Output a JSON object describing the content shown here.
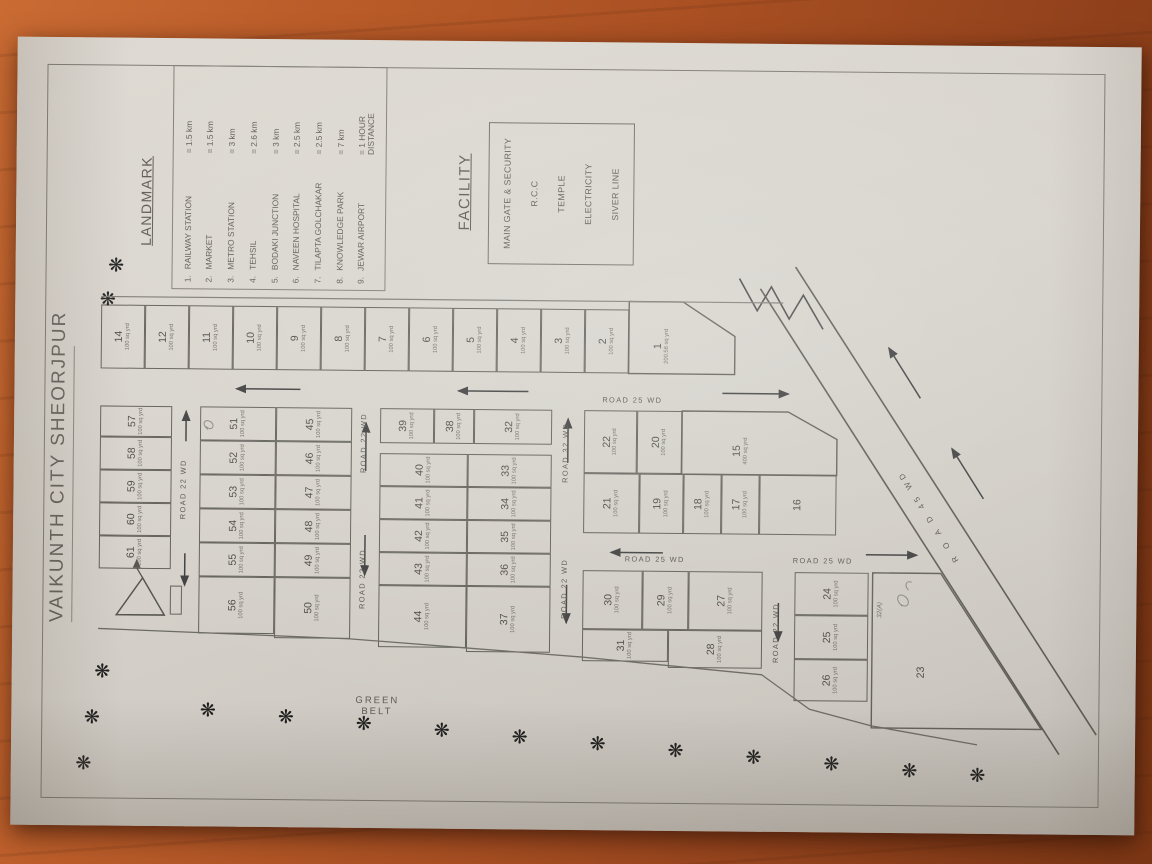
{
  "title": "VAIKUNTH CITY SHEORJPUR",
  "landmark": {
    "header": "LANDMARK",
    "items": [
      {
        "num": "1.",
        "name": "RAILWAY STATION",
        "value": "= 1.5 km"
      },
      {
        "num": "2.",
        "name": "MARKET",
        "value": "= 1.5 km"
      },
      {
        "num": "3.",
        "name": "METRO STATION",
        "value": "= 3 km"
      },
      {
        "num": "4.",
        "name": "TEHSIL",
        "value": "= 2.6 km"
      },
      {
        "num": "5.",
        "name": "BODAKI JUNCTION",
        "value": "= 3 km"
      },
      {
        "num": "6.",
        "name": "NAVEEN HOSPITAL",
        "value": "= 2.5 km"
      },
      {
        "num": "7.",
        "name": "TILAPTA GOLCHAKAR",
        "value": "= 2.5 km"
      },
      {
        "num": "8.",
        "name": "KNOWLEDGE PARK",
        "value": "= 7 km"
      },
      {
        "num": "9.",
        "name": "JEWAR AIRPORT",
        "value": "= 1 HOUR DISTANCE"
      }
    ]
  },
  "facility": {
    "header": "FACILITY",
    "items": [
      "MAIN GATE & SECURITY",
      "R.C.C",
      "TEMPLE",
      "ELECTRICITY",
      "SIVER LINE"
    ]
  },
  "green_belt": {
    "line1": "GREEN",
    "line2": "BELT"
  },
  "roads": {
    "r1": "ROAD 22 WD",
    "r2_left": "ROAD 22 WD",
    "r2_right": "ROAD 22 WD",
    "r3_left": "ROAD 22 WD",
    "r3_right": "ROAD 32 WD",
    "r4": "ROAD 22 WD",
    "v1": "ROAD 25 WD",
    "v2_upper": "ROAD 25 WD",
    "v2_lower": "ROAD 25 WD",
    "diag": "R O A D 45 WD"
  },
  "annotations": {
    "plot23_suffix": "32(A)"
  },
  "icons": {
    "tree": "❋"
  },
  "plots": {
    "1": {
      "n": "1",
      "a": "200.58 sq yrd"
    },
    "2": {
      "n": "2",
      "a": "100 sq yrd"
    },
    "3": {
      "n": "3",
      "a": "100 sq yrd"
    },
    "4": {
      "n": "4",
      "a": "100 sq yrd"
    },
    "5": {
      "n": "5",
      "a": "100 sq yrd"
    },
    "6": {
      "n": "6",
      "a": "100 sq yrd"
    },
    "7": {
      "n": "7",
      "a": "100 sq yrd"
    },
    "8": {
      "n": "8",
      "a": "100 sq yrd"
    },
    "9": {
      "n": "9",
      "a": "100 sq yrd"
    },
    "10": {
      "n": "10",
      "a": "100 sq yrd"
    },
    "11": {
      "n": "11",
      "a": "100 sq yrd"
    },
    "12": {
      "n": "12",
      "a": "100 sq yrd"
    },
    "14": {
      "n": "14",
      "a": "100 sq yrd"
    },
    "15": {
      "n": "15",
      "a": "400 sq yrd"
    },
    "16": {
      "n": "16"
    },
    "17": {
      "n": "17",
      "a": "100 sq yrd"
    },
    "18": {
      "n": "18",
      "a": "100 sq yrd"
    },
    "19": {
      "n": "19",
      "a": "100 sq yrd"
    },
    "20": {
      "n": "20",
      "a": "100 sq yrd"
    },
    "21": {
      "n": "21",
      "a": "100 sq yrd"
    },
    "22": {
      "n": "22",
      "a": "100 sq yrd"
    },
    "23": {
      "n": "23"
    },
    "24": {
      "n": "24",
      "a": "100 sq yrd"
    },
    "25": {
      "n": "25",
      "a": "100 sq yrd"
    },
    "26": {
      "n": "26",
      "a": "100 sq yrd"
    },
    "27": {
      "n": "27",
      "a": "100 sq yrd"
    },
    "28": {
      "n": "28",
      "a": "100 sq yrd"
    },
    "29": {
      "n": "29",
      "a": "100 sq yrd"
    },
    "30": {
      "n": "30",
      "a": "100 sq yrd"
    },
    "31": {
      "n": "31",
      "a": "100 sq yrd"
    },
    "32": {
      "n": "32",
      "a": "100 sq yrd"
    },
    "33": {
      "n": "33",
      "a": "100 sq yrd"
    },
    "34": {
      "n": "34",
      "a": "100 sq yrd"
    },
    "35": {
      "n": "35",
      "a": "100 sq yrd"
    },
    "36": {
      "n": "36",
      "a": "100 sq yrd"
    },
    "37": {
      "n": "37",
      "a": "100 sq yrd"
    },
    "38": {
      "n": "38",
      "a": "100 sq yrd"
    },
    "39": {
      "n": "39",
      "a": "100 sq yrd"
    },
    "40": {
      "n": "40",
      "a": "100 sq yrd"
    },
    "41": {
      "n": "41",
      "a": "100 sq yrd"
    },
    "42": {
      "n": "42",
      "a": "100 sq yrd"
    },
    "43": {
      "n": "43",
      "a": "100 sq yrd"
    },
    "44": {
      "n": "44",
      "a": "100 sq yrd"
    },
    "45": {
      "n": "45",
      "a": "100 sq yrd"
    },
    "46": {
      "n": "46",
      "a": "100 sq yrd"
    },
    "47": {
      "n": "47",
      "a": "100 sq yrd"
    },
    "48": {
      "n": "48",
      "a": "100 sq yrd"
    },
    "49": {
      "n": "49",
      "a": "100 sq yrd"
    },
    "50": {
      "n": "50",
      "a": "100 sq yrd"
    },
    "51": {
      "n": "51",
      "a": "100 sq yrd"
    },
    "52": {
      "n": "52",
      "a": "100 sq yrd"
    },
    "53": {
      "n": "53",
      "a": "100 sq yrd"
    },
    "54": {
      "n": "54",
      "a": "100 sq yrd"
    },
    "55": {
      "n": "55",
      "a": "100 sq yrd"
    },
    "56": {
      "n": "56",
      "a": "100 sq yrd"
    },
    "57": {
      "n": "57",
      "a": "100 sq yrd"
    },
    "58": {
      "n": "58",
      "a": "100 sq yrd"
    },
    "59": {
      "n": "59",
      "a": "100 sq yrd"
    },
    "60": {
      "n": "60",
      "a": "100 sq yrd"
    },
    "61": {
      "n": "61",
      "a": "100 sq yrd"
    }
  }
}
